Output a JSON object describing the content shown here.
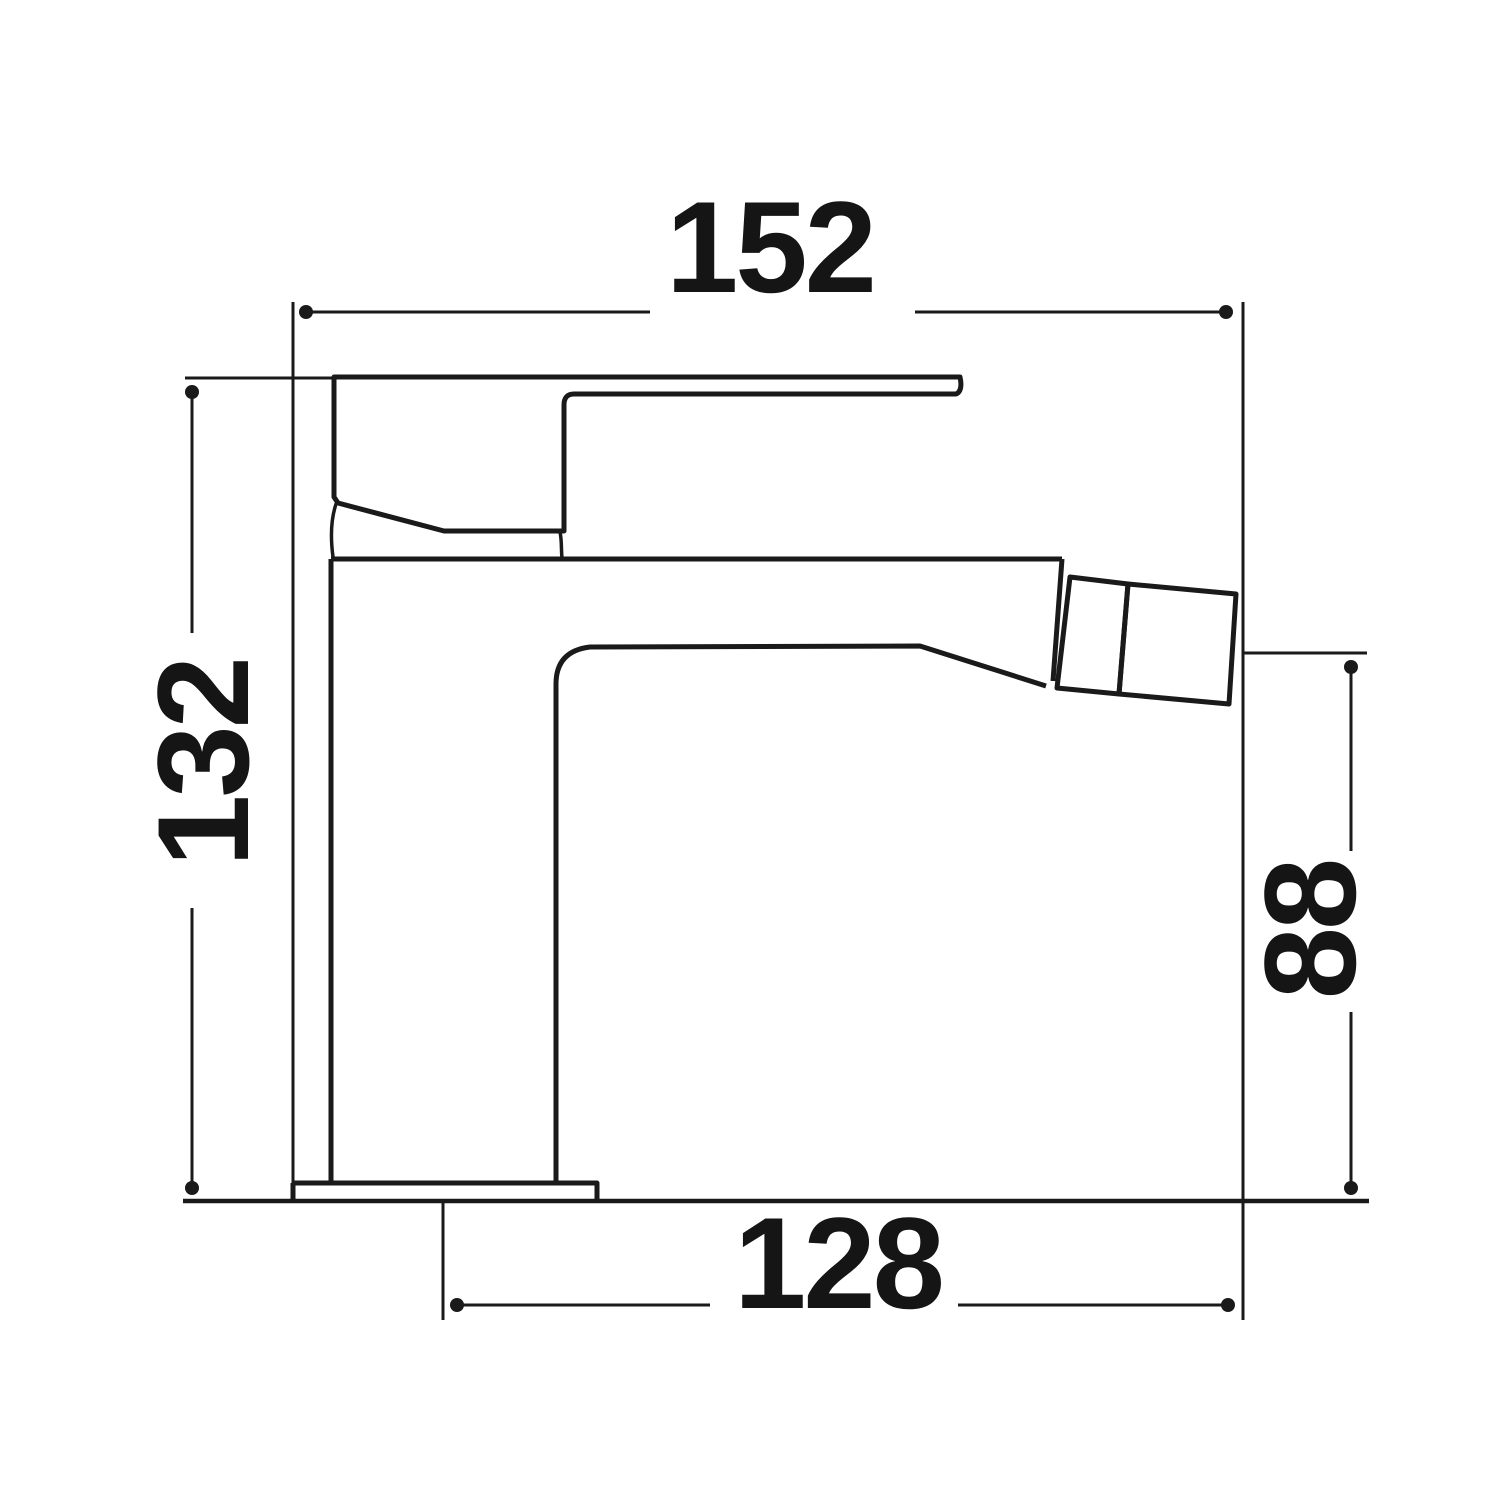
{
  "page": {
    "background_color": "#ffffff",
    "line_color": "#1a1a1a"
  },
  "drawing": {
    "kind": "faucet side-view dimension drawing",
    "dims": {
      "top": {
        "value": "152",
        "orientation": "horizontal",
        "position": "top"
      },
      "left": {
        "value": "132",
        "orientation": "vertical",
        "position": "left"
      },
      "right": {
        "value": "88",
        "orientation": "vertical",
        "position": "right"
      },
      "bottom": {
        "value": "128",
        "orientation": "horizontal",
        "position": "bottom"
      }
    }
  }
}
